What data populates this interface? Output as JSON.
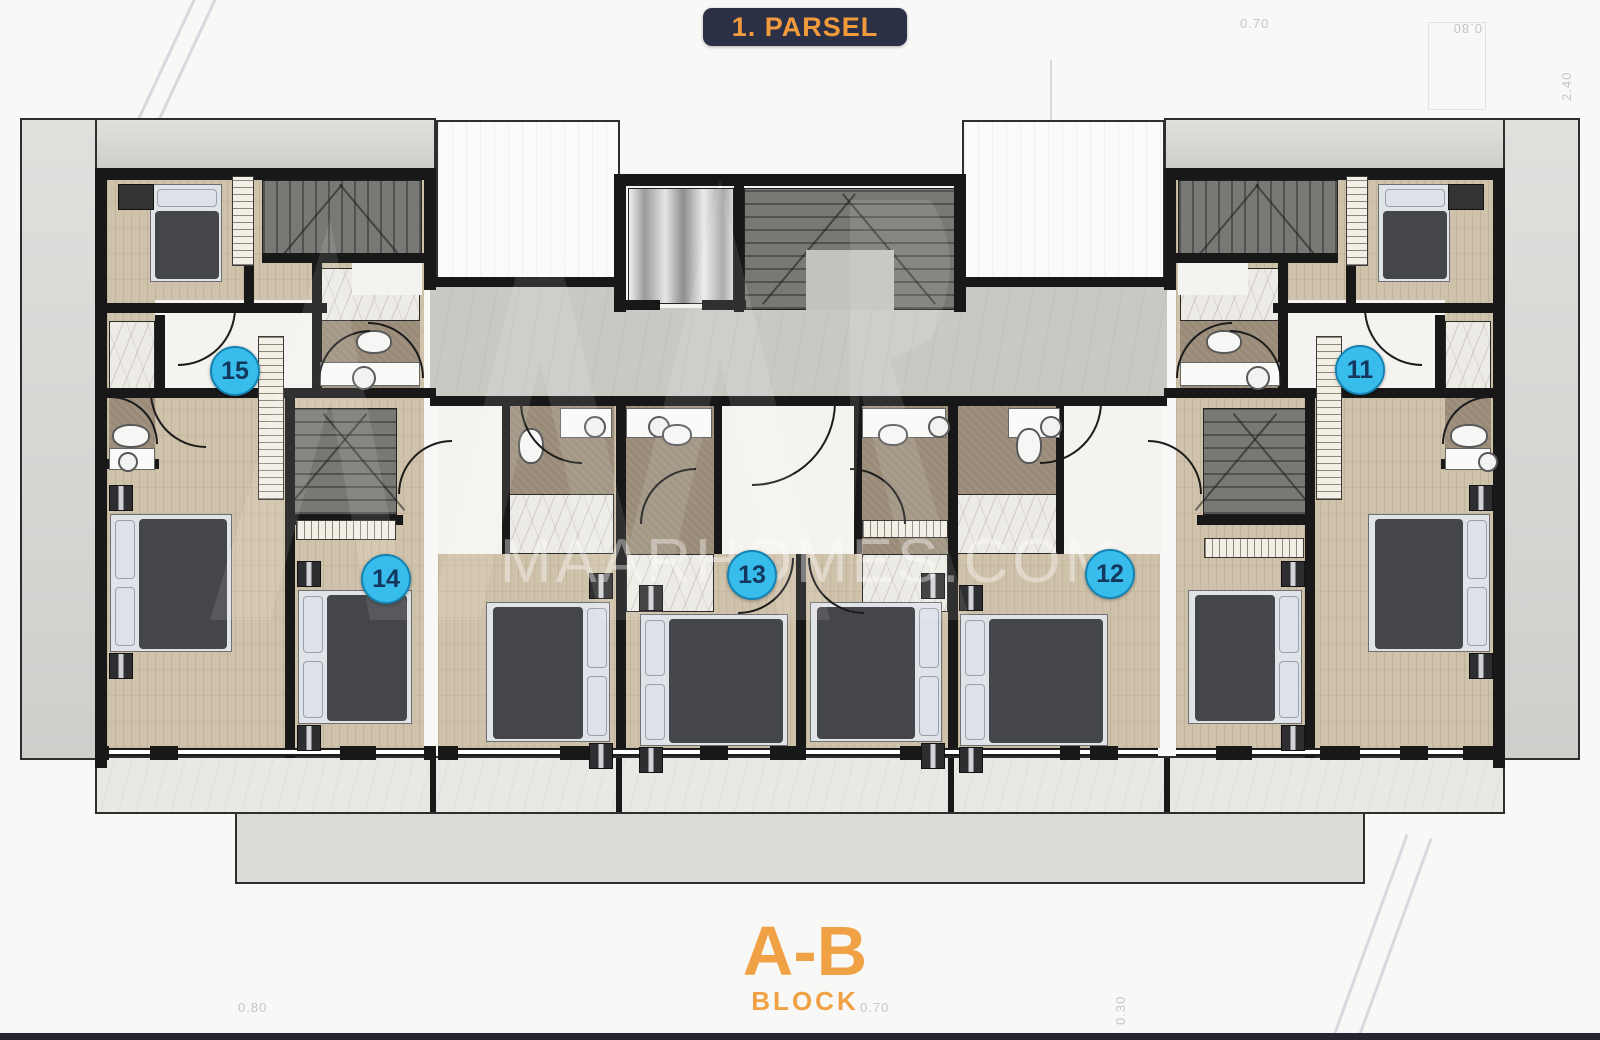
{
  "badge": {
    "label": "1. PARSEL"
  },
  "block_label": {
    "title": "A-B",
    "subtitle": "BLOCK"
  },
  "watermark": {
    "text": "MAARHOMES.COM"
  },
  "units": [
    {
      "id": "15",
      "x": 233,
      "y": 369
    },
    {
      "id": "14",
      "x": 384,
      "y": 577
    },
    {
      "id": "13",
      "x": 750,
      "y": 573
    },
    {
      "id": "12",
      "x": 1108,
      "y": 572
    },
    {
      "id": "11",
      "x": 1358,
      "y": 368
    }
  ],
  "colors": {
    "accent_orange": "#f29b3c",
    "title_badge_bg": "#2b3046",
    "unit_badge_fill": "#38bcec",
    "unit_badge_border": "#1583b2",
    "unit_badge_text": "#14375e",
    "wall": "#181818"
  },
  "dimension_labels": [
    {
      "text": "0.80",
      "x": 238,
      "y": 1000,
      "rot": 0
    },
    {
      "text": "0.70",
      "x": 860,
      "y": 1000,
      "rot": 0
    },
    {
      "text": "0.30",
      "x": 1100,
      "y": 996,
      "rot": -90
    },
    {
      "text": "2.40",
      "x": 1546,
      "y": 72,
      "rot": -90
    },
    {
      "text": "0.80",
      "x": 1440,
      "y": 20,
      "rot": 180
    },
    {
      "text": "0.70",
      "x": 1240,
      "y": 16,
      "rot": 0
    },
    {
      "text": "2.50",
      "x": 1008,
      "y": 148,
      "rot": -90
    },
    {
      "text": "1.00",
      "x": 1196,
      "y": 804,
      "rot": 0
    },
    {
      "text": "0.36",
      "x": 348,
      "y": 862,
      "rot": 0
    },
    {
      "text": "1.40",
      "x": 28,
      "y": 640,
      "rot": -90
    }
  ]
}
